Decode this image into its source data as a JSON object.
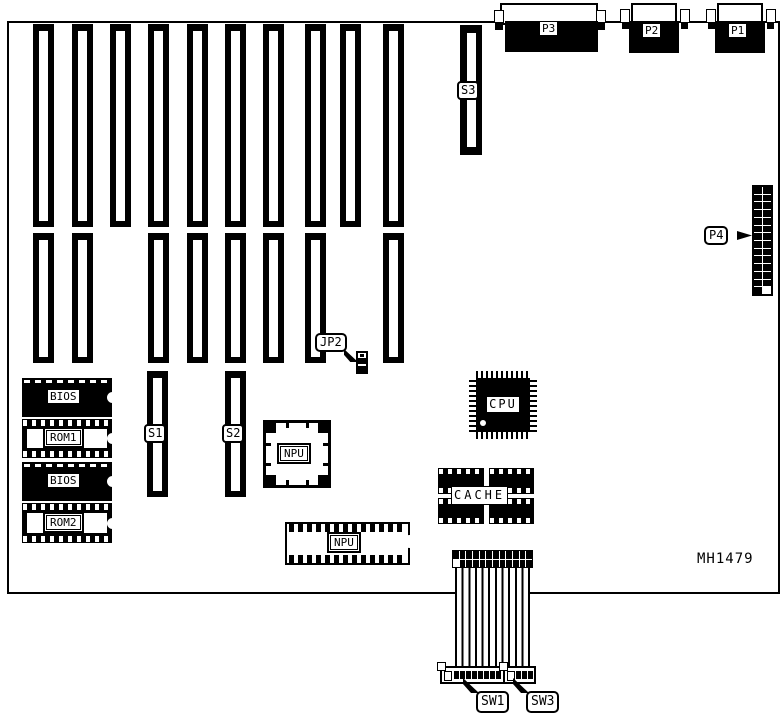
{
  "diagram": {
    "part_number": "MH1479",
    "labels": {
      "p1": "P1",
      "p2": "P2",
      "p3": "P3",
      "p4": "P4",
      "s1": "S1",
      "s2": "S2",
      "s3": "S3",
      "jp2": "JP2",
      "sw1": "SW1",
      "sw3": "SW3",
      "bios": "BIOS",
      "rom1": "ROM1",
      "rom2": "ROM2",
      "cpu": "CPU",
      "cache": "CACHE",
      "npu": "NPU"
    },
    "expansion_slots": {
      "upper_row_count": 10,
      "lower_row_count": 8
    },
    "colors": {
      "ink": "#000000",
      "paper": "#ffffff"
    }
  }
}
